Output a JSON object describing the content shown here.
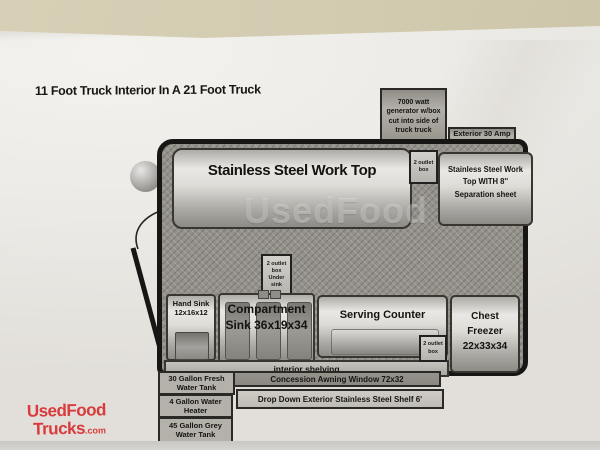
{
  "title": "11 Foot Truck Interior In A 21 Foot Truck",
  "watermark_text": "UsedFood",
  "boxes": {
    "generator": "7000 watt generator w/box cut into side of truck truck",
    "exterior_plug": "Exterior 30 Amp Plug",
    "worktop_main": "Stainless Steel Work Top",
    "worktop_right": {
      "lines": [
        "Stainless Steel Work",
        "Top WITH 8''",
        "Separation sheet"
      ]
    },
    "outlet_top": "2 outlet box",
    "outlet_under_sink": "2 outlet box Under sink",
    "outlet_serving": "2 outlet box",
    "hand_sink": "Hand Sink 12x16x12",
    "compartment_sink": "Compartment Sink 36x19x34",
    "serving_counter": "Serving Counter",
    "chest_freezer": "Chest Freezer 22x33x34",
    "interior_shelving": "interior shelving",
    "fresh_tank": "30 Gallon Fresh Water Tank",
    "awning_window": "Concession Awning Window 72x32",
    "water_heater": "4 Gallon Water Heater",
    "drop_shelf": "Drop Down Exterior Stainless Steel Shelf 6'",
    "grey_tank": "45 Gallon Grey Water Tank"
  },
  "logo": {
    "top": "UsedFood",
    "bottom": "Trucks",
    "tld": ".com"
  },
  "colors": {
    "wall_beige": "#d2cbb0",
    "paper_white": "#efede9",
    "logo_red": "#d93a3c",
    "truck_outline": "#181614",
    "floor_grey": "#94918a",
    "metal_light": "#e9e8e4",
    "metal_dark": "#8d8b86"
  }
}
